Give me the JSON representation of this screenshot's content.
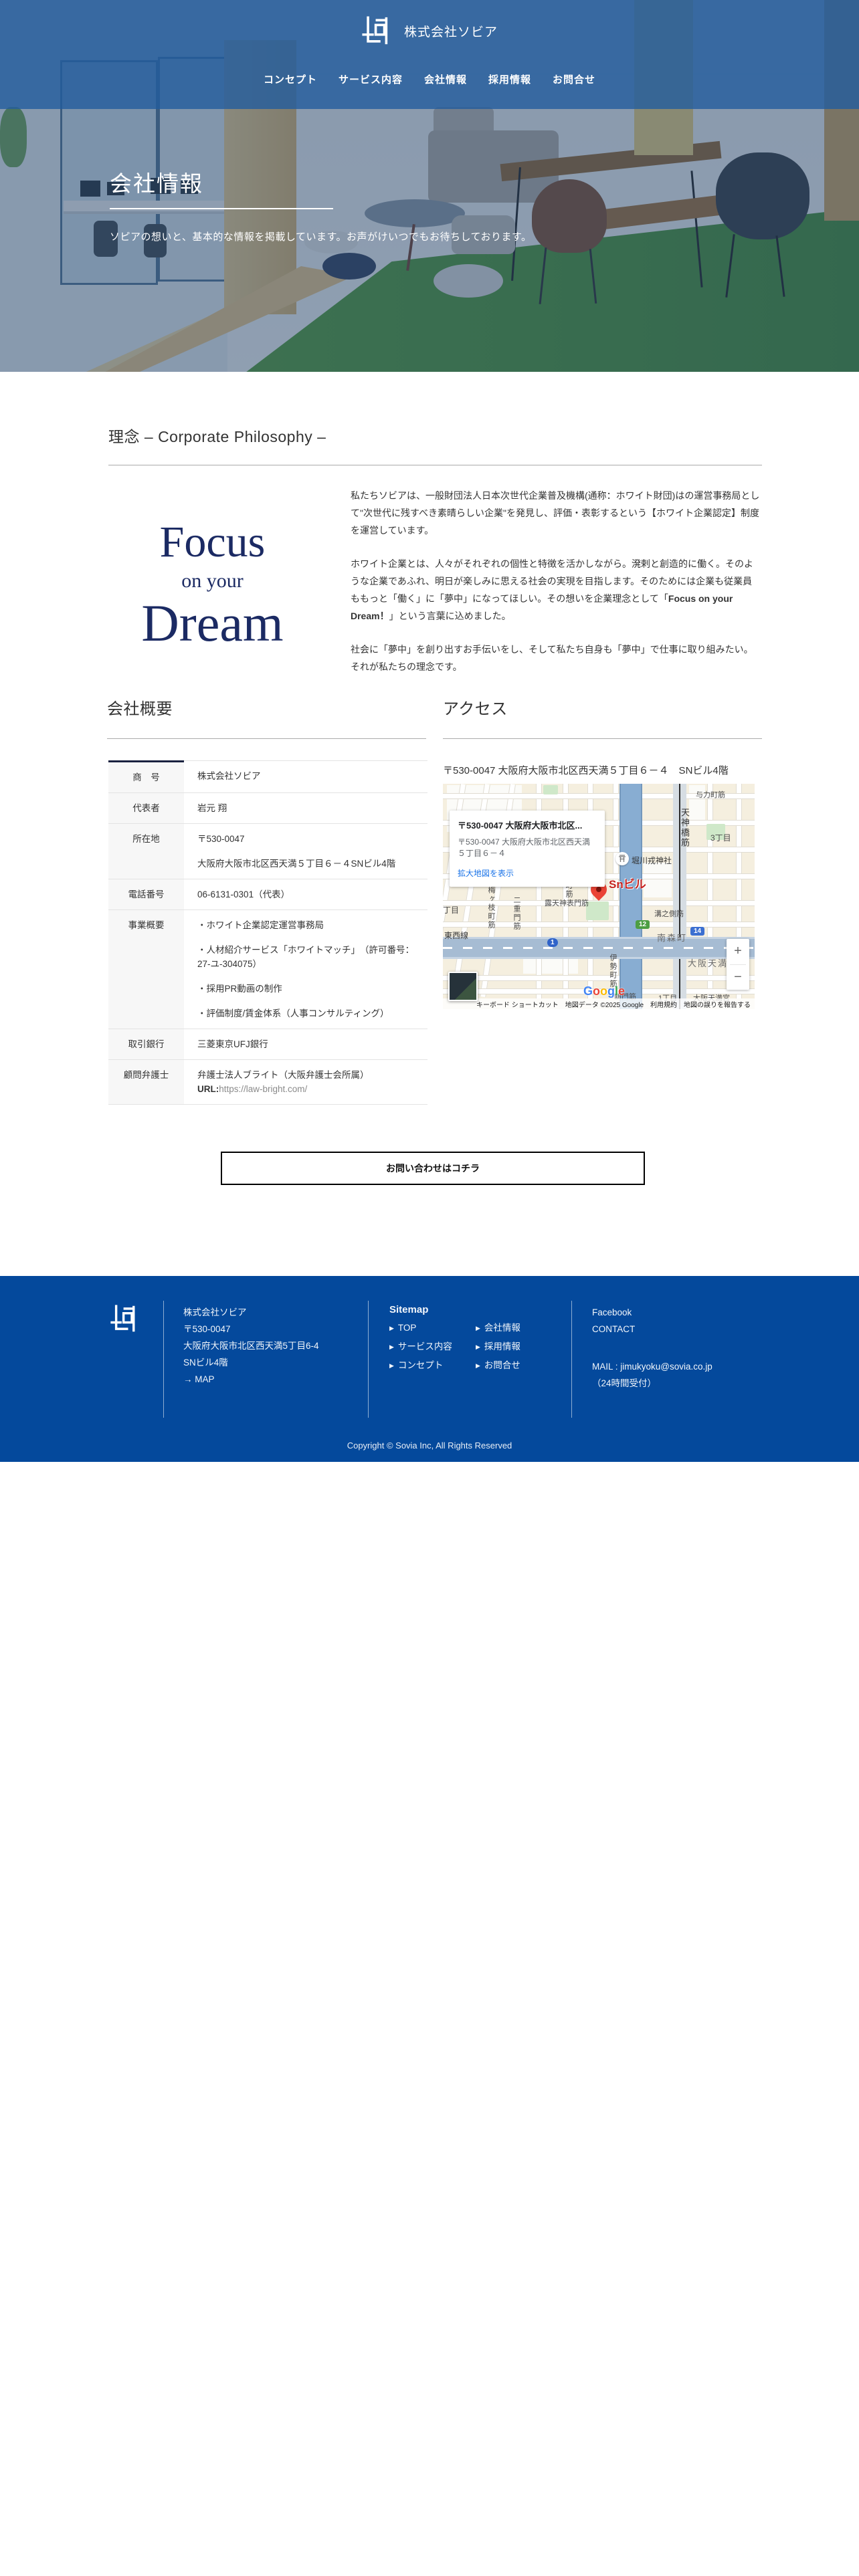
{
  "colors": {
    "header_blue": "#33689f",
    "footer_blue": "#04499c",
    "accent_navy": "#1b2a63",
    "pin_red": "#ea4335",
    "link_blue": "#1a73e8"
  },
  "header": {
    "company_name": "株式会社ソビア",
    "nav": [
      "コンセプト",
      "サービス内容",
      "会社情報",
      "採用情報",
      "お問合せ"
    ]
  },
  "hero": {
    "title": "会社情報",
    "subtitle": "ソピアの想いと、基本的な情報を掲載しています。お声がけいつでもお待ちしております。"
  },
  "philosophy": {
    "heading": "理念 – Corporate Philosophy –",
    "slogan": {
      "line1": "Focus",
      "line2": "on your",
      "line3": "Dream"
    },
    "p1": "私たちソビアは、一般財団法人日本次世代企業普及機構(通称：ホワイト財団)はの運営事務局として\"次世代に残すべき素晴らしい企業\"を発見し、評価・表彰するという【ホワイト企業認定】制度を運営しています。",
    "p2_pre": "ホワイト企業とは、人々がそれぞれの個性と特徴を活かしながら。溌剌と創造的に働く。そのような企業であふれ、明日が楽しみに思える社会の実現を目指します。そのためには企業も従業員ももっと「働く」に「夢中」になってほしい。その想いを企業理念として「",
    "p2_bold": "Focus on your Dream！",
    "p2_post": "」という言葉に込めました。",
    "p3": "社会に「夢中」を創り出すお手伝いをし、そして私たち自身も「夢中」で仕事に取り組みたい。それが私たちの理念です。"
  },
  "company": {
    "heading": "会社概要",
    "table": [
      {
        "label": "商　号",
        "lines": [
          "株式会社ソビア"
        ]
      },
      {
        "label": "代表者",
        "lines": [
          "岩元 翔"
        ]
      },
      {
        "label": "所在地",
        "lines": [
          "〒530-0047",
          "大阪府大阪市北区西天満５丁目６－４SNビル4階"
        ]
      },
      {
        "label": "電話番号",
        "lines": [
          "06-6131-0301（代表）"
        ]
      },
      {
        "label": "事業概要",
        "lines": [
          "・ホワイト企業認定運営事務局",
          "・人材紹介サービス「ホワイトマッチ」　（許可番号：27-ユ-304075）",
          "・採用PR動画の制作",
          "・評価制度/賃金体系（人事コンサルティング）"
        ]
      },
      {
        "label": "取引銀行",
        "lines": [
          "三菱東京UFJ銀行"
        ]
      },
      {
        "label": "顧問弁護士",
        "line1": "弁護士法人ブライト（大阪弁護士会所属）",
        "url_label": "URL:",
        "url": "https://law-bright.com/"
      }
    ]
  },
  "access": {
    "heading": "アクセス",
    "address": "〒530-0047 大阪府大阪市北区西天満５丁目６－４　SNビル4階",
    "map": {
      "card_title": "〒530-0047 大阪府大阪市北区...",
      "card_address": "〒530-0047 大阪府大阪市北区西天満５丁目６－４",
      "card_link": "拡大地図を表示",
      "pin_label": "Snビル",
      "labels": {
        "yoriki": "与力町筋",
        "tenjinbashisuji": "天神橋筋",
        "sanchome": "3丁目",
        "shrine": "堀川戎神社",
        "kobatacho": "木幡町筋",
        "rotenjin": "露天神表門筋",
        "nishiumegaeda": "西梅ヶ枝町筋",
        "nijumon": "二重門筋",
        "chome": "丁目",
        "tozaisen": "東西線",
        "mizonosoba": "溝之側筋",
        "minamimorimachi": "南森町",
        "osakatemma": "大阪天満",
        "isemachisuji": "伊勢町筋",
        "shinmonsuji": "新門筋",
        "itchome": "1丁目",
        "temmangu": "大阪天満宮"
      },
      "badges": {
        "r1": "1",
        "r12": "12",
        "r14": "14"
      },
      "google_letters": [
        "G",
        "o",
        "o",
        "g",
        "l",
        "e"
      ],
      "zoom_in": "+",
      "zoom_out": "−",
      "attribution": {
        "shortcuts": "キーボード ショートカット",
        "data": "地図データ ©2025 Google",
        "terms": "利用規約",
        "report": "地図の誤りを報告する"
      }
    }
  },
  "cta": {
    "label": "お問い合わせはコチラ"
  },
  "footer": {
    "company": "株式会社ソビア",
    "zip": "〒530-0047",
    "address1": "大阪府大阪市北区西天満5丁目6-4",
    "address2": "SNビル4階",
    "map_link": "→ MAP",
    "sitemap_title": "Sitemap",
    "arrow": "▶",
    "sitemap_col1": [
      "TOP",
      "サービス内容",
      "コンセプト"
    ],
    "sitemap_col2": [
      "会社情報",
      "採用情報",
      "お問合せ"
    ],
    "social": [
      "Facebook",
      "CONTACT"
    ],
    "mail": "MAIL : jimukyoku@sovia.co.jp",
    "hours": "（24時間受付）",
    "copyright": "Copyright © Sovia Inc, All Rights Reserved"
  }
}
